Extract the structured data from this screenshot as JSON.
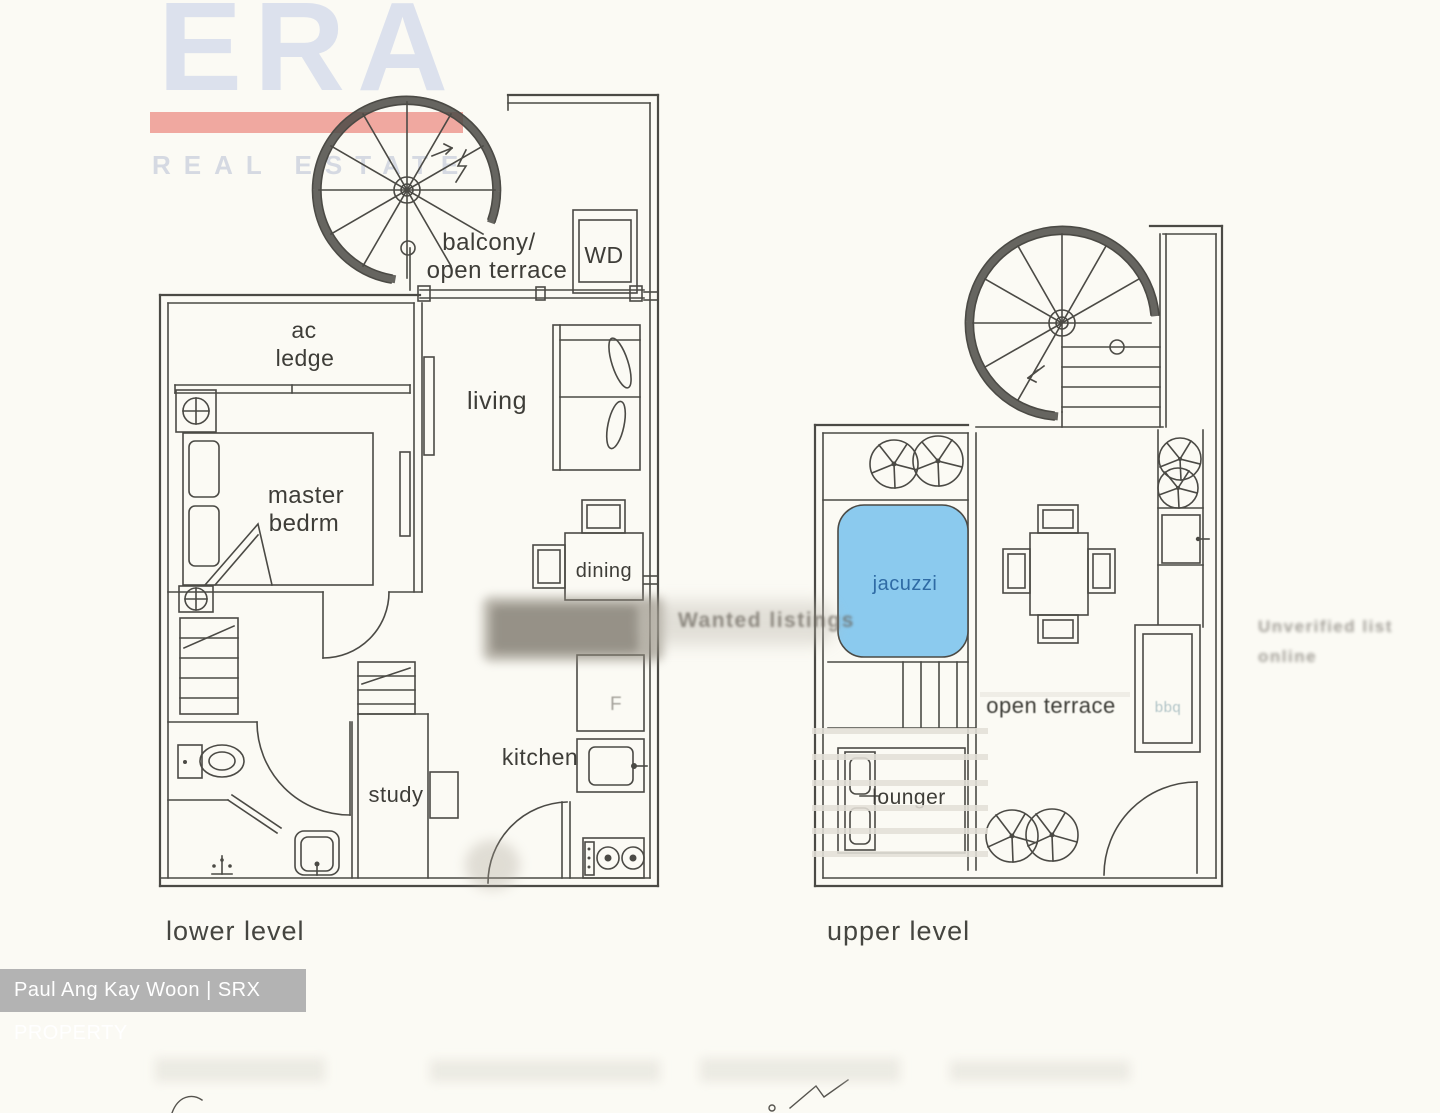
{
  "background": "#fbfaf4",
  "logo": {
    "brand": "ERA",
    "subtitle": "REAL ESTATE"
  },
  "credit_bar": {
    "text": "Paul Ang Kay Woon | SRX PROPERTY"
  },
  "lower_level": {
    "caption": "lower level",
    "labels": {
      "balcony_line1": "balcony/",
      "balcony_line2": "open terrace",
      "wd": "WD",
      "ac_line1": "ac",
      "ac_line2": "ledge",
      "master_line1": "master",
      "master_line2": "bedrm",
      "living": "living",
      "dining": "dining",
      "kitchen": "kitchen",
      "study": "study",
      "fridge": "F"
    }
  },
  "upper_level": {
    "caption": "upper level",
    "labels": {
      "jacuzzi": "jacuzzi",
      "open_terrace": "open terrace",
      "lounger": "lounger",
      "bbq": "bbq"
    }
  },
  "ghost_watermarks": {
    "center": "Wanted listings",
    "right_line1": "Unverified list",
    "right_line2": "online"
  },
  "colors": {
    "plan_line": "#4b4a45",
    "label_text": "#3e3d38",
    "logo_text": "#dce1ed",
    "logo_bar": "#f0a8a0",
    "logo_subtitle": "#d5d9e2",
    "credit_bg": "#b3b3b3",
    "credit_text": "#ffffff",
    "jacuzzi_fill": "#8bcaee",
    "jacuzzi_text": "#2f6ba5"
  }
}
